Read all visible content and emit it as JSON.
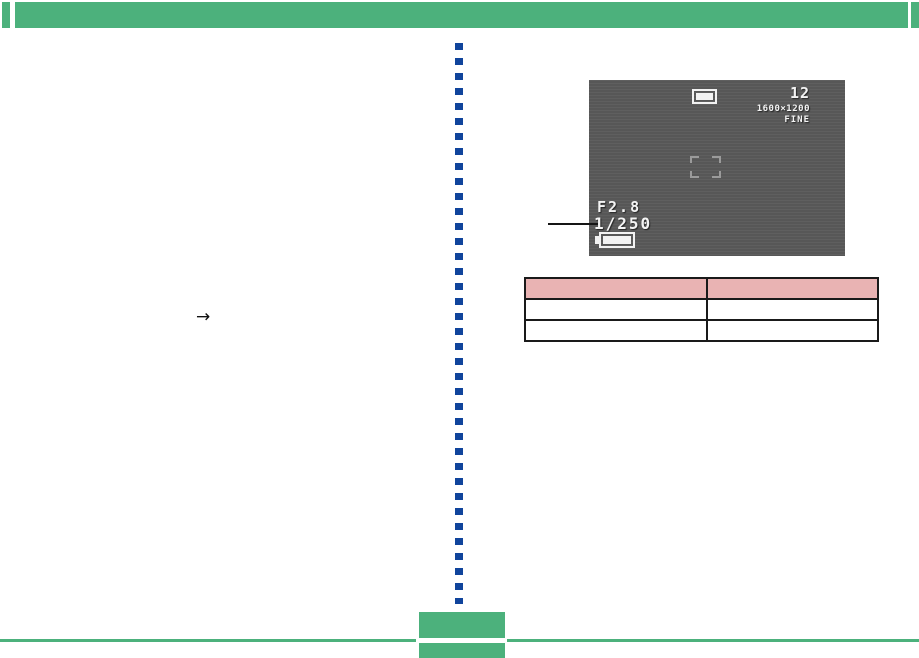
{
  "header": {
    "style": "solid green rule with square end caps"
  },
  "camera_screen": {
    "shots_remaining": "12",
    "resolution": "1600×1200",
    "quality": "FINE",
    "aperture": "F2.8",
    "shutter_speed": "1/250"
  },
  "annotations": {
    "arrow_glyph": "→",
    "callout_target": "shutter-speed-value"
  },
  "table": {
    "header": [
      "",
      ""
    ],
    "rows": [
      [
        "",
        ""
      ],
      [
        "",
        ""
      ]
    ]
  },
  "colors": {
    "accent_green": "#4cb17c",
    "accent_blue": "#10449c",
    "screen_gray": "#5a5a5a",
    "table_header_pink": "#e9b3b3"
  }
}
